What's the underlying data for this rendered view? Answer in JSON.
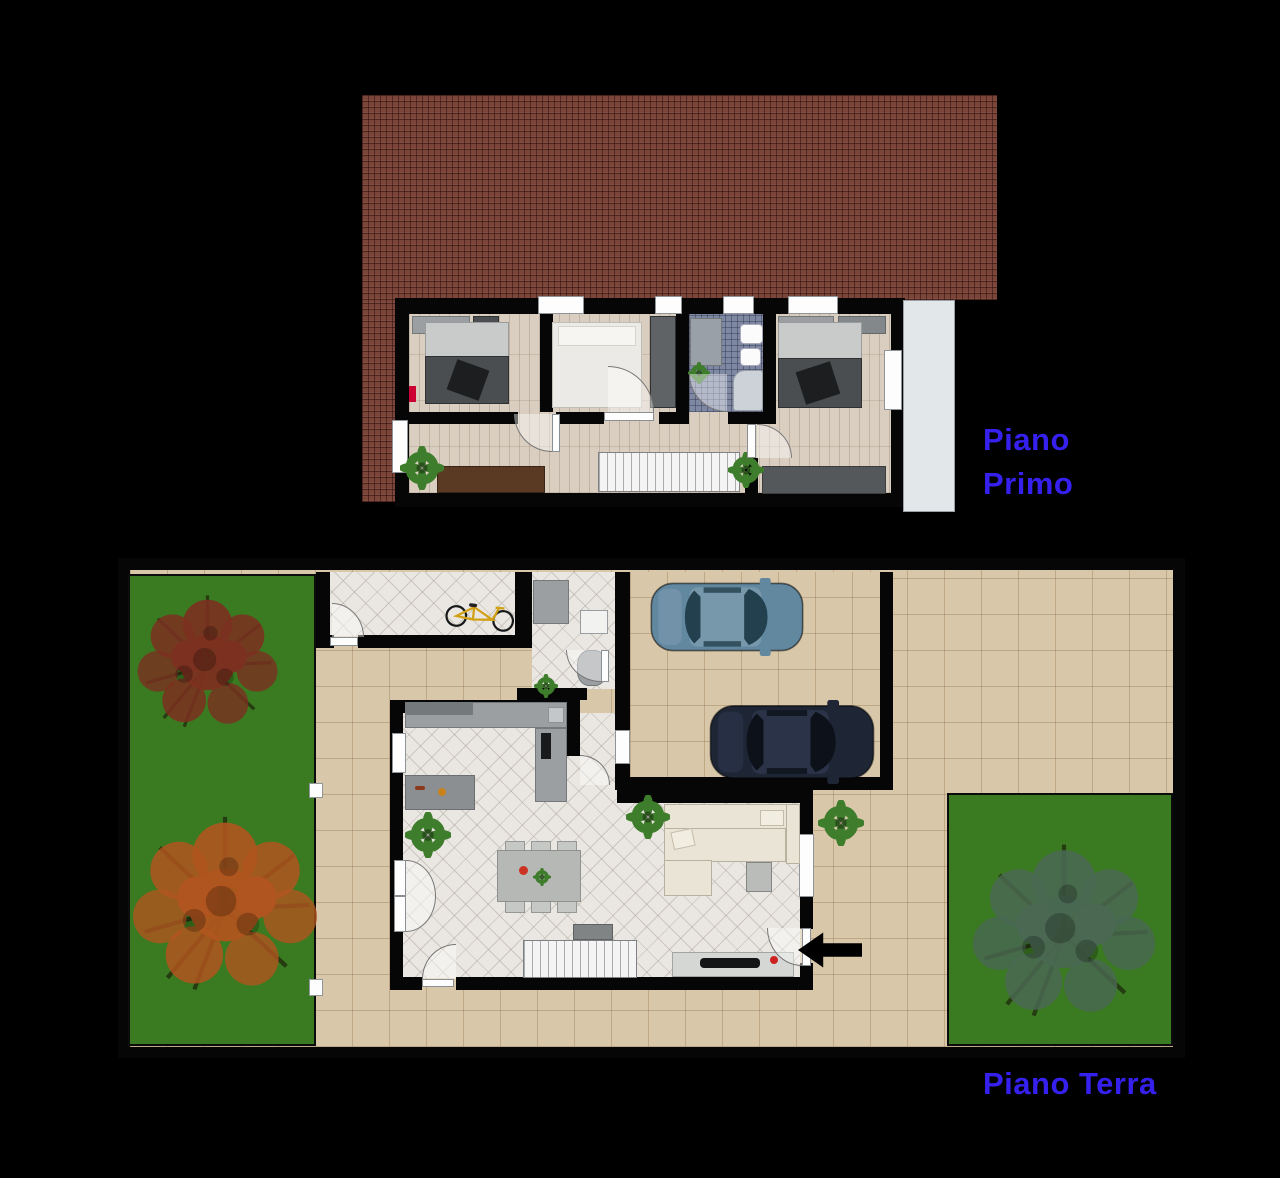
{
  "floors": {
    "first": {
      "label_line1": "Piano",
      "label_line2": "Primo"
    },
    "ground": {
      "label": "Piano Terra"
    }
  },
  "colors": {
    "background": "#000000",
    "label_blue": "#3520ee",
    "wall": "#060606",
    "roof_base": "#7b453a",
    "wood": "#d9cec0",
    "tile": "#eae7e2",
    "paving": "#d8c7a8",
    "garden": "#3a7a21",
    "terrace": "#e2e7ea",
    "bath_tile": "#7f88a3",
    "stairs": "#f4f4f4",
    "counter": "#9b9fa2",
    "furniture_dark": "#4b4e50",
    "bed_white": "#eceae6",
    "sofa": "#eae4d6",
    "sideboard_brown": "#5a3a22",
    "desk_dark": "#55585a",
    "table_gray": "#b5b8b5",
    "chair_gray": "#c6c8c6",
    "rug_gray": "#8b8f91",
    "tv_black": "#141516",
    "car_blue_body": "#6288a0",
    "car_blue_cabin": "#7797ab",
    "car_blue_glass": "#23404e",
    "car_dark_body": "#1e2636",
    "car_dark_cabin": "#2a3348",
    "car_dark_glass": "#0d1119",
    "tree_red": "#7c3020",
    "tree_orange": "#b0551f",
    "tree_green": "#4a6852",
    "plant_green": "#3e7d2b",
    "bike_yellow": "#d2a014",
    "arrow_black": "#000000"
  },
  "icons": {
    "trees": [
      "autumn-tree-icon",
      "autumn-tree-icon",
      "green-tree-icon"
    ],
    "cars": [
      "blue-car-icon",
      "dark-car-icon"
    ],
    "bicycle": "bicycle-icon",
    "entrance_arrow": "entrance-arrow-icon"
  }
}
